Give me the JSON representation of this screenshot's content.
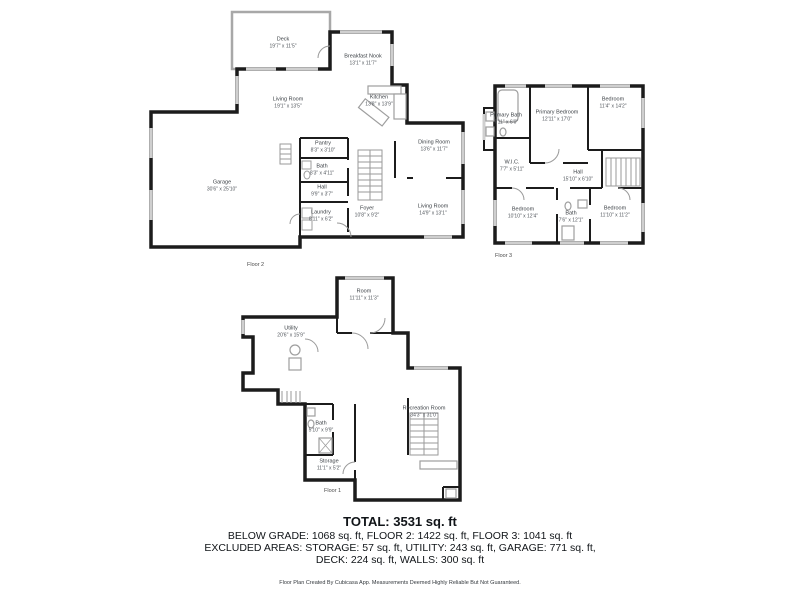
{
  "colors": {
    "wall": "#1c1c1c",
    "window": "#cfcfcf",
    "fixture": "#9e9e9e",
    "background": "#ffffff"
  },
  "floors": [
    {
      "label": "Floor 2",
      "rooms": [
        {
          "name": "Deck",
          "dims": "19'7\" x 11'5\""
        },
        {
          "name": "Breakfast Nook",
          "dims": "13'1\" x 11'7\""
        },
        {
          "name": "Living Room",
          "dims": "19'1\" x 13'5\""
        },
        {
          "name": "Kitchen",
          "dims": "13'8\" x 13'9\""
        },
        {
          "name": "Pantry",
          "dims": "8'3\" x 3'10\""
        },
        {
          "name": "Bath",
          "dims": "8'3\" x 4'11\""
        },
        {
          "name": "Hall",
          "dims": "9'9\" x 3'7\""
        },
        {
          "name": "Dining Room",
          "dims": "13'6\" x 11'7\""
        },
        {
          "name": "Laundry",
          "dims": "8'11\" x 6'2\""
        },
        {
          "name": "Foyer",
          "dims": "10'8\" x 9'2\""
        },
        {
          "name": "Living Room",
          "dims": "14'9\" x 13'1\""
        },
        {
          "name": "Garage",
          "dims": "30'6\" x 25'10\""
        }
      ]
    },
    {
      "label": "Floor 3",
      "rooms": [
        {
          "name": "Primary Bath",
          "dims": "7'11\" x 6'0\""
        },
        {
          "name": "Primary Bedroom",
          "dims": "12'11\" x 17'0\""
        },
        {
          "name": "Bedroom",
          "dims": "11'4\" x 14'2\""
        },
        {
          "name": "W.I.C.",
          "dims": "7'7\" x 5'11\""
        },
        {
          "name": "Hall",
          "dims": "15'10\" x 6'10\""
        },
        {
          "name": "Bedroom",
          "dims": "10'10\" x 12'4\""
        },
        {
          "name": "Bath",
          "dims": "7'6\" x 12'1\""
        },
        {
          "name": "Bedroom",
          "dims": "11'10\" x 11'2\""
        }
      ]
    },
    {
      "label": "Floor 1",
      "rooms": [
        {
          "name": "Room",
          "dims": "11'11\" x 11'3\""
        },
        {
          "name": "Utility",
          "dims": "20'6\" x 15'9\""
        },
        {
          "name": "Bath",
          "dims": "5'10\" x 9'9\""
        },
        {
          "name": "Storage",
          "dims": "11'1\" x 5'2\""
        },
        {
          "name": "Recreation Room",
          "dims": "34'3\" x 31'0\""
        }
      ]
    }
  ],
  "summary": {
    "total": "TOTAL: 3531 sq. ft",
    "line2": "BELOW GRADE: 1068 sq. ft, FLOOR 2: 1422 sq. ft, FLOOR 3: 1041 sq. ft",
    "line3": "EXCLUDED AREAS: STORAGE: 57 sq. ft, UTILITY: 243 sq. ft, GARAGE: 771 sq. ft,",
    "line4": "DECK: 224 sq. ft, WALLS: 300 sq. ft",
    "footer": "Floor Plan Created By Cubicasa App. Measurements Deemed Highly Reliable But Not Guaranteed."
  }
}
